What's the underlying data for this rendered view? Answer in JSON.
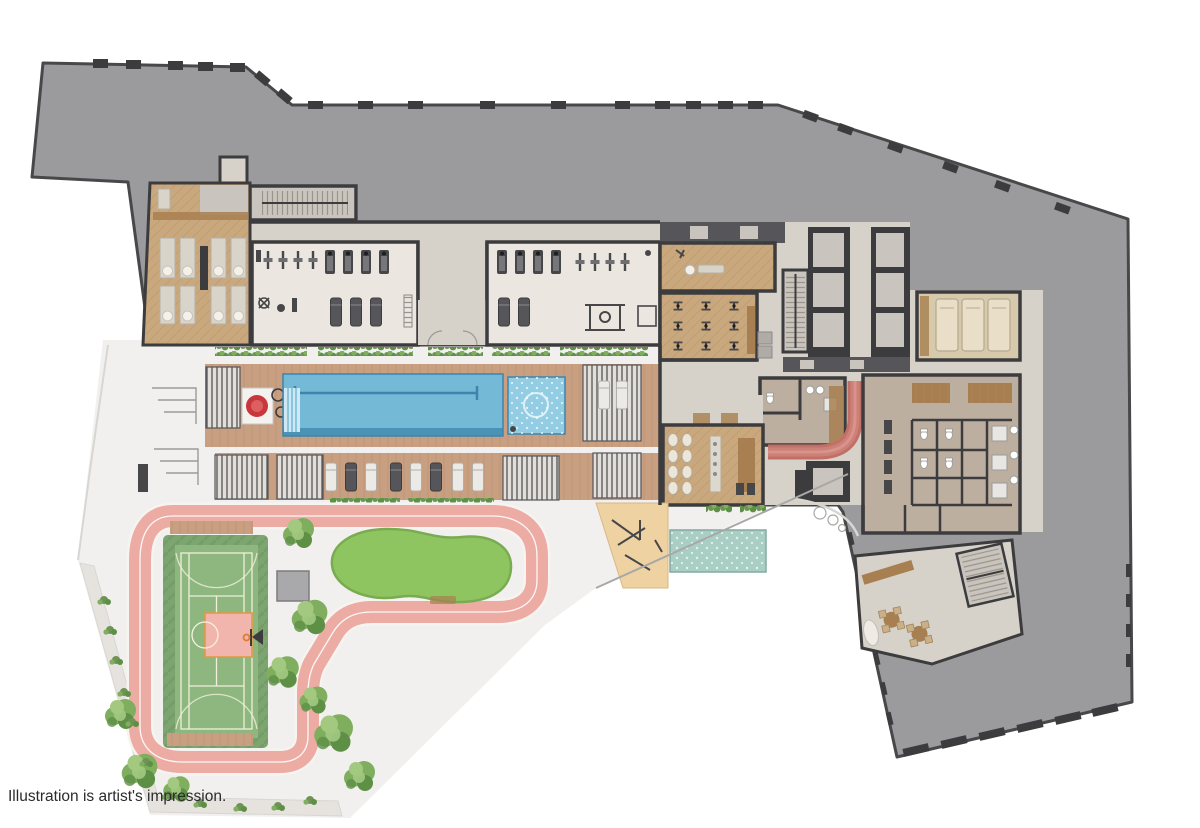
{
  "caption": {
    "text": "Illustration is artist's impression."
  },
  "palette": {
    "background": "#ffffff",
    "roof": "#9b9b9d",
    "roof_edge": "#48484a",
    "wall": "#3c3c3e",
    "wall_light": "#55555a",
    "floor": "#d6d1c9",
    "floor_light": "#ebe7e0",
    "floor_cool": "#c9c4bd",
    "wood": "#c9a87e",
    "wood_dark": "#a87f50",
    "wood_plank": "#b08a5f",
    "deck": "#c89f80",
    "deck_plank": "#b68e6f",
    "taupe": "#bcafa0",
    "taupe_dark": "#a99c8c",
    "cream": "#e9dfc8",
    "cream_dark": "#d7c9ab",
    "pool": "#74b9d6",
    "pool_dark": "#3d85ac",
    "pool_light": "#cfe9f4",
    "spa": "#93cde3",
    "kids_pool": "#a9cfc5",
    "sand": "#eed2a2",
    "track_pink": "#ecaca4",
    "track_red": "#c27067",
    "track_red_mid": "#cd8077",
    "track_red_light": "#d8938a",
    "court_green": "#8db77f",
    "court_apron": "#7ca570",
    "court_line": "#f5f2e0",
    "key_pink": "#f2b5ad",
    "key_line": "#e09a44",
    "lawn": "#8ec561",
    "lawn_edge": "#79ab50",
    "tree": "#7fae5f",
    "tree_dark": "#5d8f45",
    "tree_light": "#a3c981",
    "shrub": "#6d9455",
    "paving": "#f1f0ee",
    "paving_line": "#d8d6d2",
    "gravel": "#e6e3de",
    "slat_bg": "#e2dfda",
    "glyph": "#47474a",
    "white": "#f6f4f0",
    "hoop_orange": "#e07b2e",
    "caption": "#2b2b2b"
  },
  "zones": [
    "rooftop",
    "residents-dining-room",
    "pantry",
    "stairs-northwest",
    "entry-vestibule",
    "fitness-studio-west",
    "fitness-studio-east",
    "yoga-studio",
    "spin-studio",
    "stair-core",
    "elevator-core",
    "sauna-treatment-room",
    "changing-rooms",
    "steam-rooms",
    "lounge-cafe",
    "indoor-jogging-track",
    "service-elevator",
    "lap-pool",
    "spa-pool",
    "pool-steps",
    "pool-art-feature",
    "pool-deck",
    "cabanas",
    "sun-loungers",
    "kids-pool",
    "sand-play-area",
    "outdoor-gym",
    "running-track",
    "multi-sport-court",
    "basketball-key",
    "basketball-hoop",
    "lawn",
    "garden-shed",
    "court-benches",
    "trees",
    "landscaping-strip",
    "club-lounge",
    "stairs-southeast",
    "terrace-steps",
    "wc-fixtures"
  ]
}
